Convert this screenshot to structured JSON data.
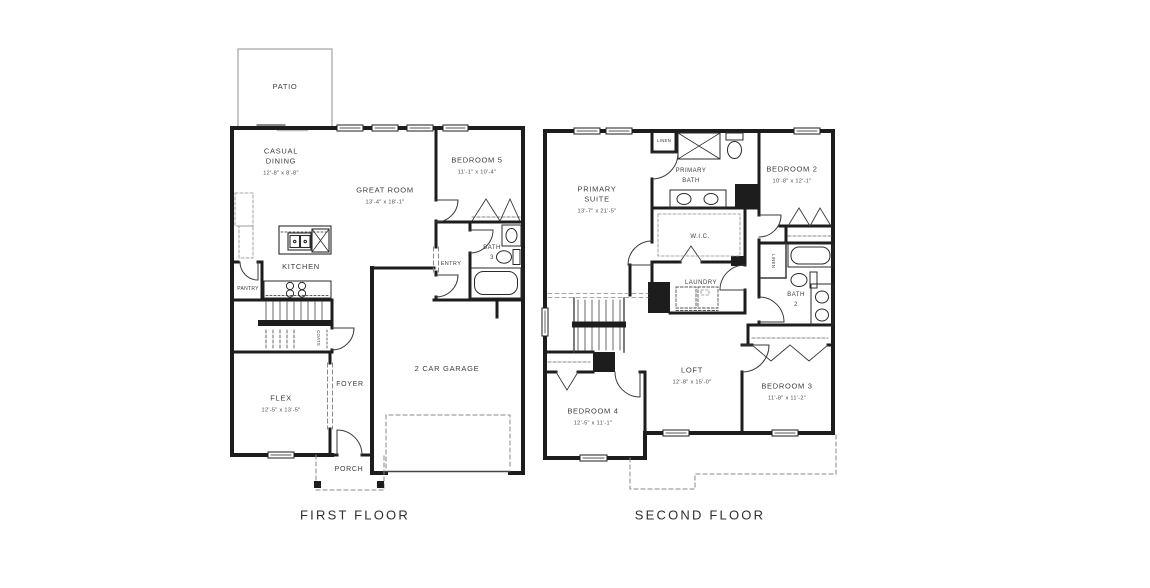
{
  "first_floor": {
    "title": "FIRST FLOOR",
    "rooms": {
      "patio": {
        "name": "PATIO"
      },
      "casual_dining": {
        "name": "CASUAL DINING",
        "dims": "12'-8\" x 8'-8\""
      },
      "great_room": {
        "name": "GREAT ROOM",
        "dims": "13'-4\" x 18'-1\""
      },
      "bedroom5": {
        "name": "BEDROOM 5",
        "dims": "11'-1\" x 10'-4\""
      },
      "kitchen": {
        "name": "KITCHEN"
      },
      "pantry": {
        "name": "PANTRY"
      },
      "bath3": {
        "name": "BATH",
        "number": "3"
      },
      "entry": {
        "name": "ENTRY"
      },
      "coats": {
        "name": "COATS"
      },
      "flex": {
        "name": "FLEX",
        "dims": "12'-5\" x 13'-5\""
      },
      "foyer": {
        "name": "FOYER"
      },
      "garage": {
        "name": "2 CAR GARAGE"
      },
      "porch": {
        "name": "PORCH"
      }
    }
  },
  "second_floor": {
    "title": "SECOND FLOOR",
    "rooms": {
      "primary_suite": {
        "name": "PRIMARY SUITE",
        "dims": "13'-7\" x 21'-5\""
      },
      "primary_bath": {
        "name": "PRIMARY BATH"
      },
      "linen_top": {
        "name": "LINEN"
      },
      "bedroom2": {
        "name": "BEDROOM 2",
        "dims": "10'-8\" x 12'-1\""
      },
      "wic": {
        "name": "W.I.C."
      },
      "laundry": {
        "name": "LAUNDRY"
      },
      "linen_side": {
        "name": "LINEN"
      },
      "bath2": {
        "name": "BATH",
        "number": "2"
      },
      "loft": {
        "name": "LOFT",
        "dims": "12'-8\" x 15'-0\""
      },
      "bedroom3": {
        "name": "BEDROOM 3",
        "dims": "11'-8\" x 11'-2\""
      },
      "bedroom4": {
        "name": "BEDROOM 4",
        "dims": "12'-5\" x 11'-1\""
      }
    }
  },
  "colors": {
    "wall": "#1d1d1d",
    "label": "#3d3d3d",
    "dashed": "#8a8a8a",
    "patio_line": "#aaaaaa"
  }
}
